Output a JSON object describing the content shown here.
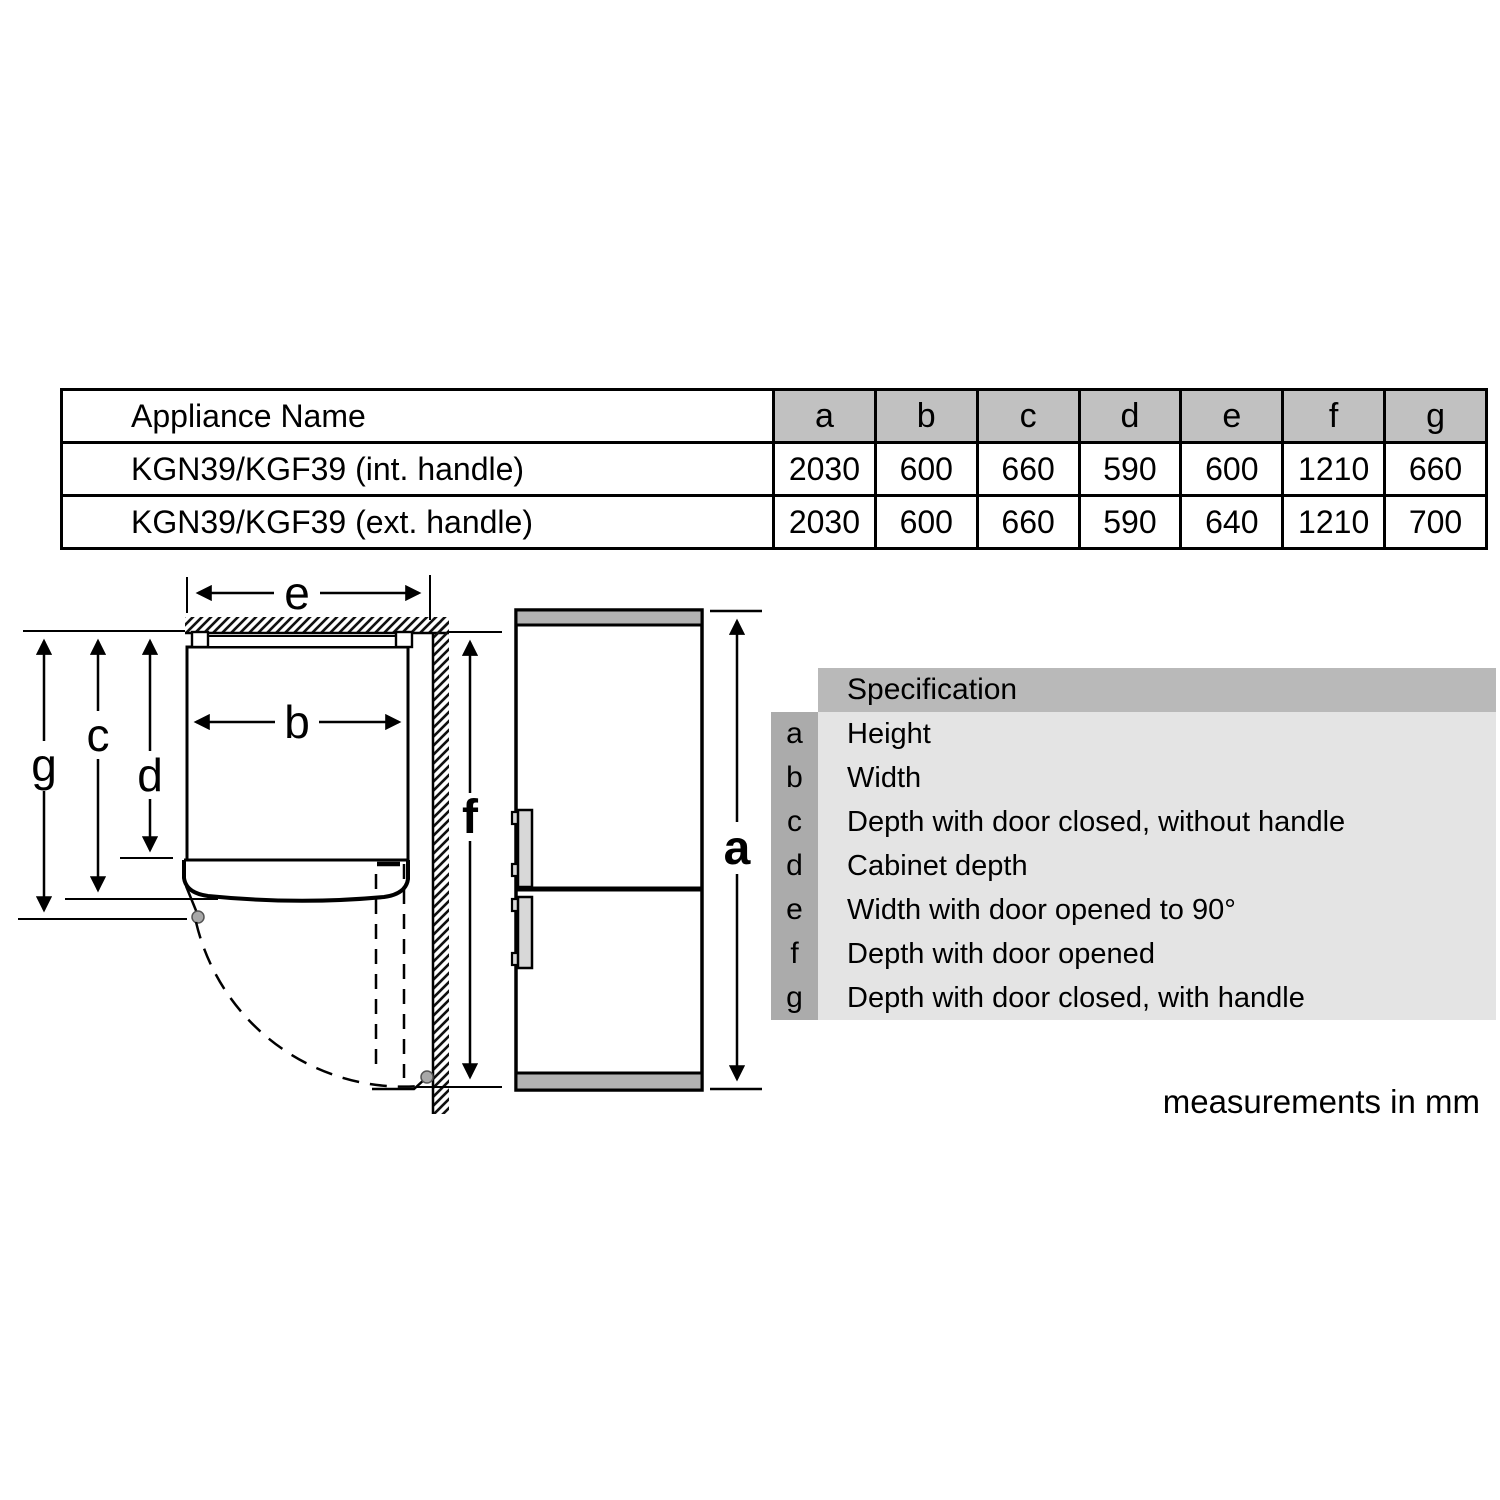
{
  "table": {
    "name_header": "Appliance Name",
    "dim_headers": [
      "a",
      "b",
      "c",
      "d",
      "e",
      "f",
      "g"
    ],
    "rows": [
      {
        "name": "KGN39/KGF39 (int. handle)",
        "values": [
          "2030",
          "600",
          "660",
          "590",
          "600",
          "1210",
          "660"
        ]
      },
      {
        "name": "KGN39/KGF39 (ext. handle)",
        "values": [
          "2030",
          "600",
          "660",
          "590",
          "640",
          "1210",
          "700"
        ]
      }
    ]
  },
  "legend": {
    "header": "Specification",
    "rows": [
      {
        "key": "a",
        "desc": "Height"
      },
      {
        "key": "b",
        "desc": "Width"
      },
      {
        "key": "c",
        "desc": "Depth with door closed, without handle"
      },
      {
        "key": "d",
        "desc": "Cabinet depth"
      },
      {
        "key": "e",
        "desc": "Width with door opened to 90°"
      },
      {
        "key": "f",
        "desc": "Depth with door opened"
      },
      {
        "key": "g",
        "desc": "Depth with door closed, with handle"
      }
    ]
  },
  "diagram": {
    "labels": {
      "width_door_open": "e",
      "width": "b",
      "depth_no_handle": "c",
      "cabinet_depth": "d",
      "depth_with_handle": "g",
      "depth_door_open": "f",
      "height": "a"
    }
  },
  "note": "measurements in mm",
  "colors": {
    "table_header_gray": "#c1c1c1",
    "legend_header_gray": "#b9b9b9",
    "legend_key_gray": "#ababab",
    "legend_body_gray": "#e4e4e4",
    "fridge_cap_gray": "#b3b3b3",
    "handle_gray": "#d8d8d8",
    "hinge_dot_gray": "#a8a8a8",
    "line_black": "#000000"
  }
}
